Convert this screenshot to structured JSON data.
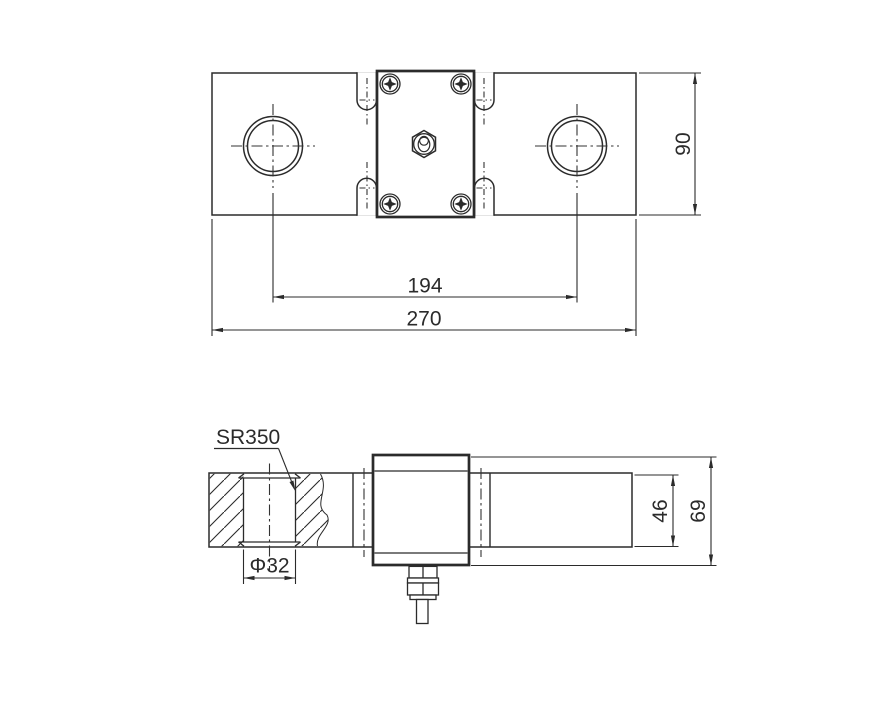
{
  "drawing": {
    "background": "#ffffff",
    "line_color": "#2b2b2b",
    "top_view": {
      "dim_hole_spacing": "194",
      "dim_overall_length": "270",
      "dim_width": "90"
    },
    "side_view": {
      "label_spherical_radius": "SR350",
      "dim_bore_diameter": "Φ32",
      "dim_beam_height": "46",
      "dim_overall_height": "69"
    }
  }
}
